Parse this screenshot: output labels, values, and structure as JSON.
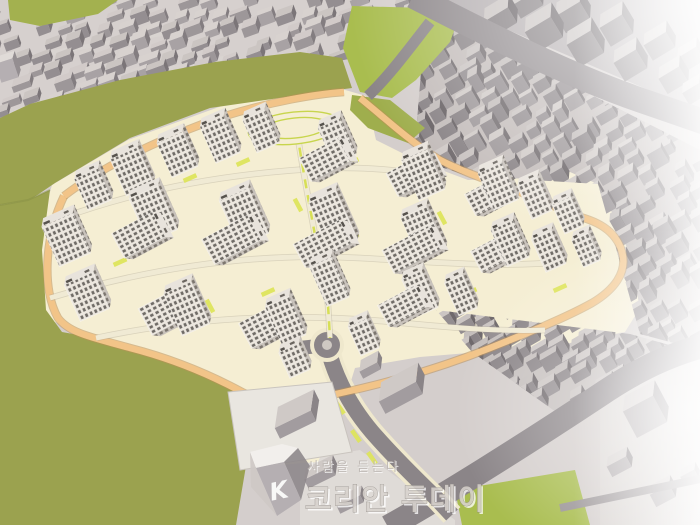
{
  "scene": {
    "subject": "Aerial 3D massing rendering of a planned high-rise apartment complex surrounded by existing low-rise city blocks, olive-green hills, a park and perimeter roads"
  },
  "watermark": {
    "logo_letter": "K",
    "tagline": "사람을 듣는다",
    "brand_name": "코리안 투데이"
  },
  "colors": {
    "canvas_gray": "#d4cecc",
    "city_ground": "#d6d0ce",
    "city_ground_east": "#c2bbb9",
    "city_ground_se": "#c5bfbd",
    "city_ground_ne": "#b0aaac",
    "olive_green": "#9ba24f",
    "olive_green_dark": "#879046",
    "park_green": "#a9bd4f",
    "road_gray": "#8b8588",
    "road_gray_light": "#9a9496",
    "complex_ground": "#f5eed3",
    "sidewalk_cream": "#efe8cd",
    "loop_road_orange": "#f2c488",
    "loop_road_casing": "#b98f57",
    "median_green": "#d7df55",
    "strip_green": "#dde45c",
    "tower_facade": "#ece7df",
    "tower_window": "#5b5752",
    "tower_side": "#c9c3bc",
    "tower_side_window": "#6e6962",
    "tower_roof": "#e8e3dc",
    "white": "#ffffff"
  }
}
